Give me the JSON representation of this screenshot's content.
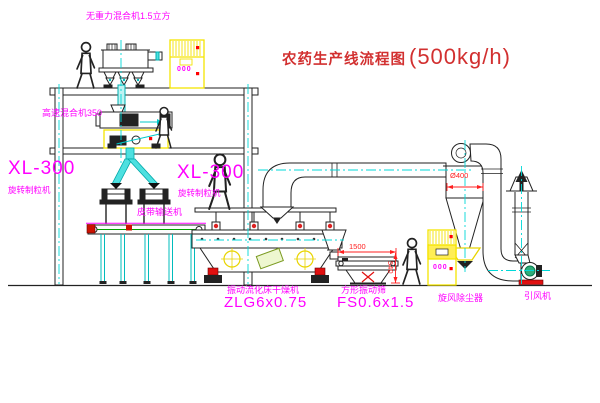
{
  "title": {
    "text": "农药生产线流程图",
    "capacity": "(500kg/h)"
  },
  "labels": {
    "gravity_mixer": "无重力混合机1.5立方",
    "high_speed_mixer": "高速混合机350",
    "granulator_left_model": "XL-300",
    "granulator_left_name": "旋转制粒机",
    "granulator_right_model": "XL-300",
    "granulator_right_name": "旋转制粒机",
    "belt_conveyor": "皮带输送机",
    "dryer_name": "振动流化床干燥机",
    "dryer_model": "ZLG6x0.75",
    "sieve_name": "方形振动筛",
    "sieve_model": "FS0.6x1.5",
    "cyclone_name": "旋风除尘器",
    "fan_name": "引风机"
  },
  "dimensions": {
    "sieve_length": "1500",
    "sieve_height": "540",
    "cyclone_diameter": "Ø400"
  },
  "control_cabinet": {
    "display_top": "000",
    "display_bottom": "000"
  },
  "colors": {
    "label_magenta": "#ff00ff",
    "title_red": "#d23030",
    "dimension_red": "#ff2020",
    "cabinet_yellow": "#f5e400",
    "centerline_cyan": "#00d8d8",
    "chute_cyan": "#4de0e0",
    "conveyor_green": "#00a000",
    "fan_green": "#2fae7a",
    "line_black": "#222222"
  }
}
